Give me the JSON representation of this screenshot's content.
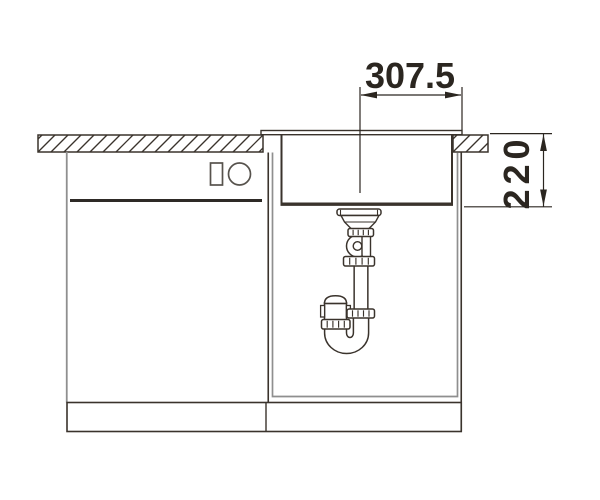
{
  "drawing": {
    "dimension_width_mm": "307.5",
    "dimension_depth_mm": "220",
    "colors": {
      "line": "#3a332c",
      "secondary_line": "#8f8f8f",
      "dimension_text": "#2b2620",
      "background": "#ffffff"
    }
  }
}
